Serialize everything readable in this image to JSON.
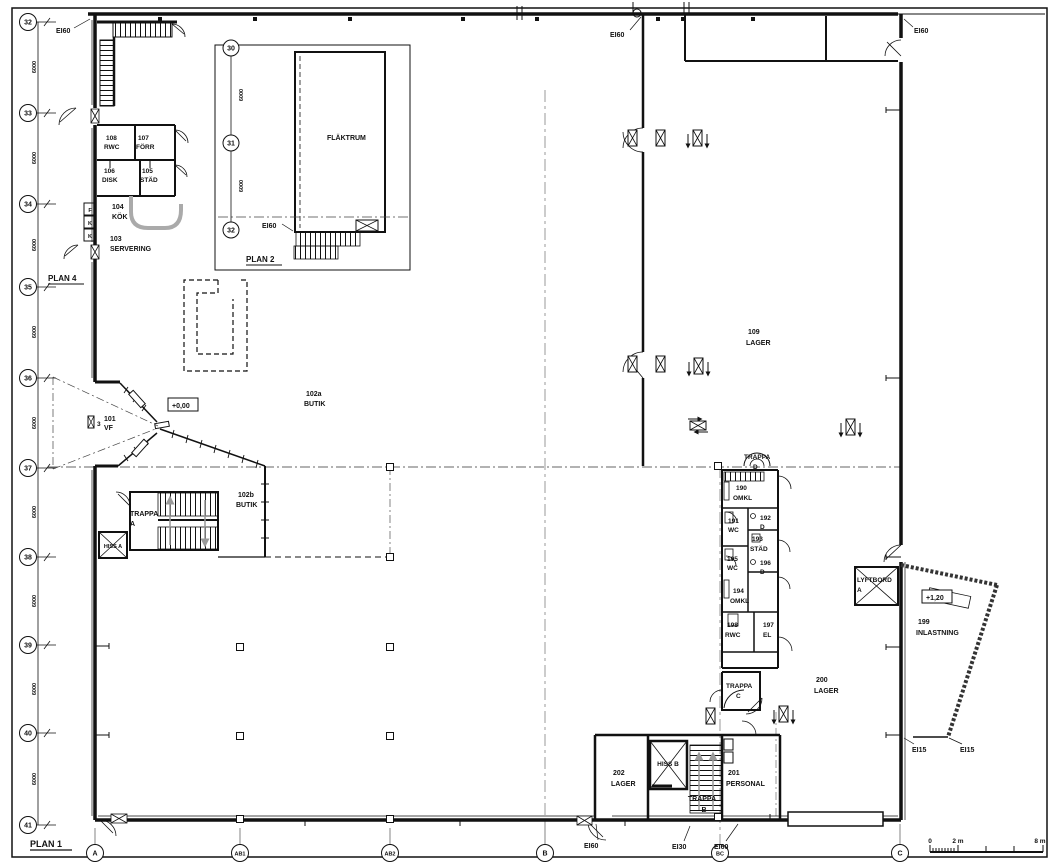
{
  "drawing": {
    "plan1": "PLAN 1",
    "plan2": "PLAN 2",
    "plan4": "PLAN 4"
  },
  "grid": {
    "left": [
      "32",
      "33",
      "34",
      "35",
      "36",
      "37",
      "38",
      "39",
      "40",
      "41"
    ],
    "bottom": [
      "A",
      "AB1",
      "AB2",
      "B",
      "BC",
      "C"
    ],
    "inset": [
      "30",
      "31",
      "32"
    ],
    "bay_dim": "6000"
  },
  "rooms": [
    {
      "num": "101",
      "name": "VF"
    },
    {
      "num": "102a",
      "name": "BUTIK"
    },
    {
      "num": "102b",
      "name": "BUTIK"
    },
    {
      "num": "103",
      "name": "SERVERING"
    },
    {
      "num": "104",
      "name": "KÖK"
    },
    {
      "num": "105",
      "name": "STÄD"
    },
    {
      "num": "106",
      "name": "DISK"
    },
    {
      "num": "107",
      "name": "FÖRR"
    },
    {
      "num": "108",
      "name": "RWC"
    },
    {
      "num": "109",
      "name": "LAGER"
    },
    {
      "num": "190",
      "name": "OMKL"
    },
    {
      "num": "191",
      "name": "WC"
    },
    {
      "num": "192",
      "name": "D"
    },
    {
      "num": "193",
      "name": "STÄD"
    },
    {
      "num": "194",
      "name": "OMKL"
    },
    {
      "num": "195",
      "name": "WC"
    },
    {
      "num": "196",
      "name": "D"
    },
    {
      "num": "197",
      "name": "EL"
    },
    {
      "num": "198",
      "name": "RWC"
    },
    {
      "num": "199",
      "name": "INLASTNING"
    },
    {
      "num": "200",
      "name": "LAGER"
    },
    {
      "num": "201",
      "name": "PERSONAL"
    },
    {
      "num": "202",
      "name": "LAGER"
    },
    {
      "num": "",
      "name": "FLÄKTRUM"
    }
  ],
  "vertical_circulation": {
    "trappa_a": {
      "l1": "TRAPPA",
      "l2": "A"
    },
    "trappa_b": {
      "l1": "TRAPPA",
      "l2": "B"
    },
    "trappa_c": {
      "l1": "TRAPPA",
      "l2": "C"
    },
    "trappa_d": {
      "l1": "TRAPPA",
      "l2": "D"
    },
    "hiss_a": "HISS A",
    "hiss_b": "HISS B",
    "lyftbord": {
      "l1": "LYFTBORD",
      "l2": "A"
    }
  },
  "levels": {
    "ground": "+0,00",
    "dock": "+1,20"
  },
  "fire_ratings": {
    "ei60": "EI60",
    "ei30": "EI30",
    "ei15": "EI15"
  },
  "shafts": {
    "f": "F",
    "k1": "K",
    "k2": "K"
  },
  "door_number": "3",
  "scalebar": {
    "zero": "0",
    "two": "2 m",
    "eight": "8 m"
  }
}
